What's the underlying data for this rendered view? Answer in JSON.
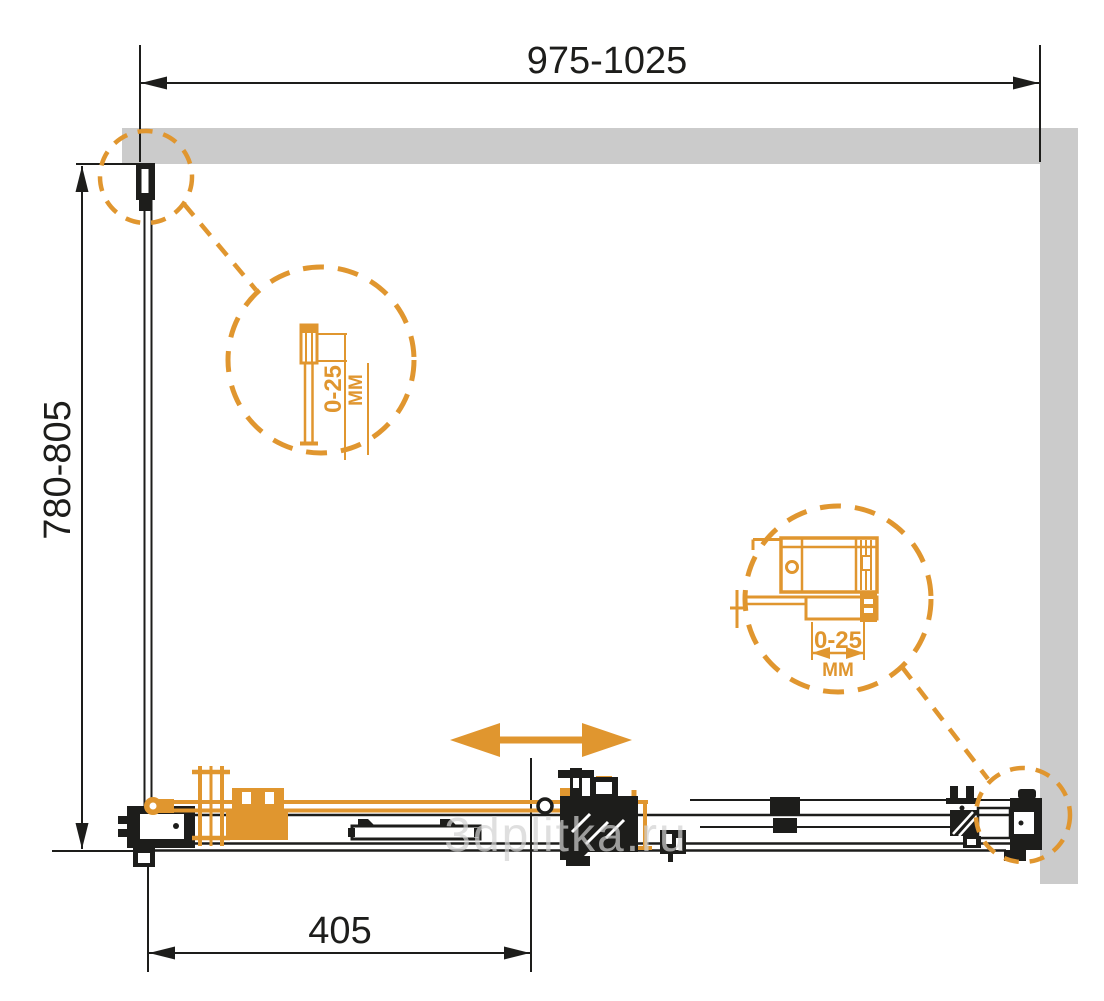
{
  "dimensions": {
    "width_label": "975-1025",
    "depth_label": "780-805",
    "door_travel_label": "405"
  },
  "callouts": {
    "left": {
      "value": "0-25",
      "unit": "MM"
    },
    "right": {
      "value": "0-25",
      "unit": "MM"
    }
  },
  "watermark": "3dplitka.ru",
  "icons": {
    "slide_direction": "double-horizontal-arrow"
  },
  "colors": {
    "line": "#1d1d1b",
    "accent": "#e0962f",
    "wall": "#cbcbcb",
    "watermark": "#d2d2d2"
  }
}
